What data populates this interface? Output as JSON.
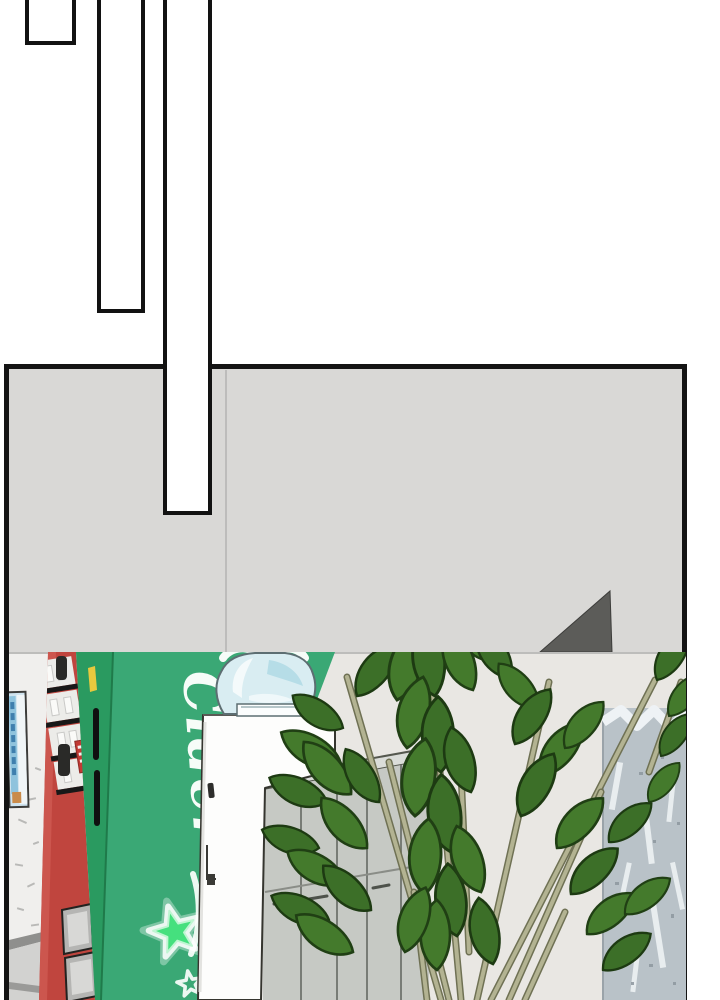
{
  "panel": {
    "wall_color": "#d9d8d6",
    "border_color": "#141414"
  },
  "transition_bars": {
    "count": 3,
    "fill": "#ffffff",
    "border": "#121212"
  },
  "photo": {
    "cider_label": "Cider",
    "colors": {
      "machine_side_green": "#3aa875",
      "machine_front_green": "#2a9a60",
      "machine_red": "#c0453e",
      "star_green": "#45e07e",
      "poster_blue": "#8fc3dd",
      "leaf_green": "#3c6f28",
      "leaf_green_alt": "#447a2c",
      "locker_gray": "#c6c9c4",
      "pillar_gray": "#b9c2c8",
      "bottle_blue": "#d9edf2",
      "left_wall": "#f0efed",
      "right_wall": "#e9e7e3"
    }
  }
}
